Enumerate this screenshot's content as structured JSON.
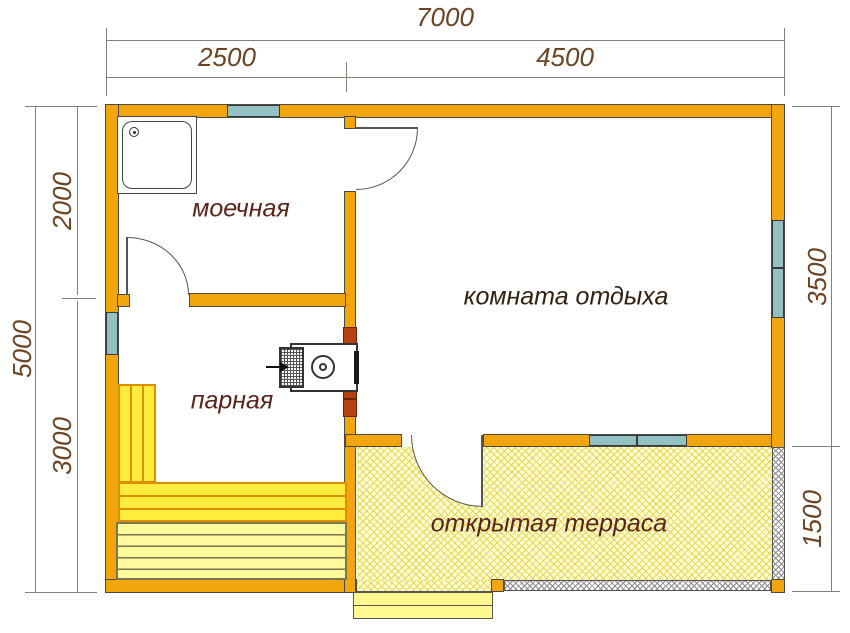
{
  "plan": {
    "title": "floor-plan-sauna",
    "rooms": {
      "washroom": "моечная",
      "steam_room": "парная",
      "rest_room": "комната отдыха",
      "terrace": "открытая терраса"
    },
    "dimensions": {
      "width_total": "7000",
      "width_left": "2500",
      "width_right": "4500",
      "height_total": "5000",
      "height_top": "2000",
      "height_bottom": "3000",
      "right_top": "3500",
      "right_bottom": "1500"
    },
    "colors": {
      "wall": "#F2A50C",
      "wall_line": "#4a4a45",
      "window": "#92C0C3",
      "brick": "#B54010",
      "brick_line": "#6E2205",
      "bench_bright": "#FFEC3D",
      "bench_pale": "#FFFA9D",
      "bench_line": "#DD8F00",
      "bench_pale_line": "#7a7650",
      "terrace_bg": "#FFFDD8",
      "terrace_line": "#E8D84F",
      "railing_line": "#8a8a8a",
      "step_bg": "#FFF98F",
      "dim_text": "#6B4423",
      "dim_line_color": "#8A7F72",
      "label_red": "#5B2418",
      "label_dark": "#33200F",
      "door_line": "#555555"
    }
  }
}
